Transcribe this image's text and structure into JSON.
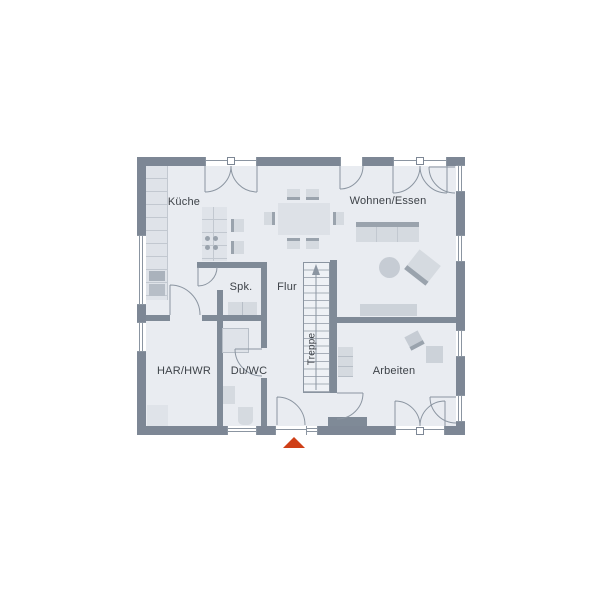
{
  "plan": {
    "type": "floor-plan",
    "floor_shown": "ground-floor",
    "rooms": {
      "kueche": {
        "label": "Küche"
      },
      "wohnen": {
        "label": "Wohnen/Essen"
      },
      "spk": {
        "label": "Spk."
      },
      "flur": {
        "label": "Flur"
      },
      "treppe": {
        "label": "Treppe"
      },
      "har": {
        "label": "HAR/HWR"
      },
      "duwc": {
        "label": "Du/WC"
      },
      "arbeiten": {
        "label": "Arbeiten"
      }
    },
    "marker": {
      "name": "entrance-marker",
      "shape": "triangle-up",
      "color": "#cf3f17"
    },
    "colors": {
      "wall": "#7d8795",
      "floor": "#e9ecf1",
      "furniture": "#d5dae0",
      "furniture_dark": "#9aa3ad",
      "line": "#8b95a1",
      "text": "#3d4248",
      "background": "#ffffff"
    }
  }
}
